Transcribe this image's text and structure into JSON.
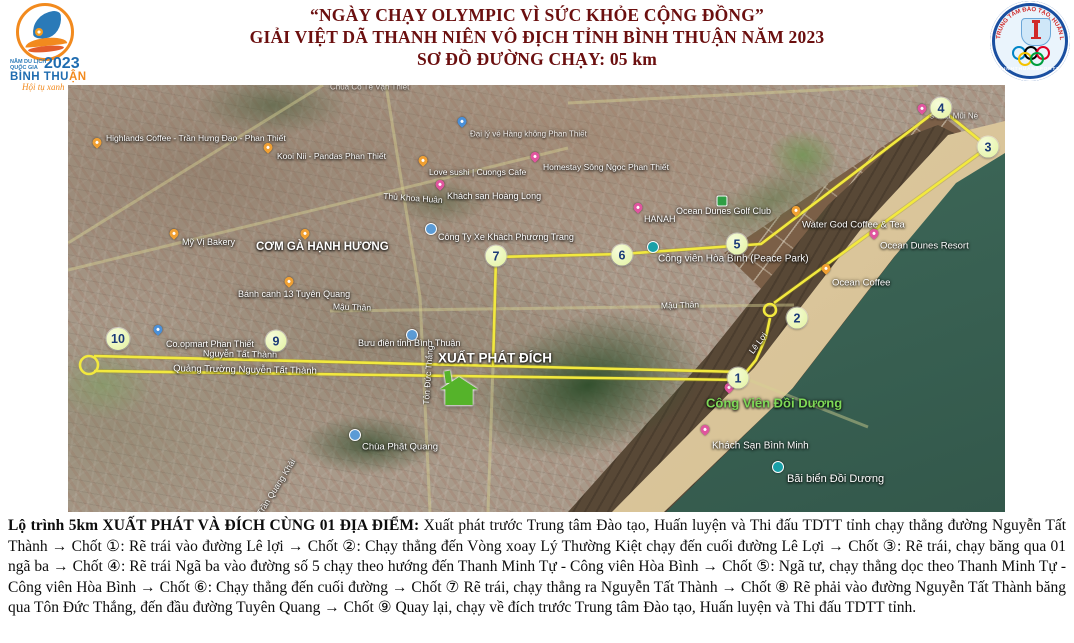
{
  "poster": {
    "title": {
      "line1": "“NGÀY CHẠY OLYMPIC VÌ SỨC KHỎE CỘNG ĐỒNG”",
      "line2": "GIẢI VIỆT DÃ THANH NIÊN VÔ ĐỊCH TỈNH BÌNH THUẬN NĂM 2023",
      "line3": "SƠ ĐỒ ĐƯỜNG CHẠY:  05 km",
      "color": "#6b0f0f"
    },
    "left_logo": {
      "line1": "NĂM DU LỊCH",
      "line2": "QUỐC GIA",
      "year": "2023",
      "name_blue": "BÌNH THU",
      "name_orange": "ẬN",
      "slogan": "Hội tụ xanh"
    },
    "right_logo": {
      "ring_text": "TRUNG TÂM ĐÀO TẠO, HUẤN LUYỆN VÀ THI ĐẤU THỂ DỤC THỂ THAO",
      "bottom_text": "BINHTHUANSPORTS",
      "ring_colors": [
        "#0085C7",
        "#000000",
        "#DF0024",
        "#F4C300",
        "#009F3D"
      ]
    },
    "description": {
      "lead": "Lộ trình 5km XUẤT PHÁT VÀ ĐÍCH CÙNG 01 ĐỊA ĐIỂM:",
      "body": "Xuất phát trước Trung tâm Đào tạo, Huấn luyện và Thi đấu TDTT tỉnh chạy thẳng đường Nguyễn Tất Thành → Chốt ①: Rẽ trái vào đường Lê lợi → Chốt ②: Chạy thẳng đến Vòng xoay Lý Thường Kiệt chạy đến cuối đường Lê Lợi → Chốt ③: Rẽ trái, chạy băng qua 01 ngã ba → Chốt ④: Rẽ trái Ngã ba vào đường số 5 chạy theo hướng đến Thanh Minh Tự - Công viên Hòa Bình → Chốt ⑤: Ngã tư, chạy thẳng dọc theo Thanh Minh Tự - Công viên Hòa Bình → Chốt ⑥: Chạy thẳng đến cuối đường → Chốt ⑦ Rẽ trái, chạy thẳng ra Nguyễn Tất Thành → Chốt ⑧ Rẽ phải vào đường Nguyễn Tất Thành băng qua Tôn Đức Thắng, đến đầu đường Tuyên Quang → Chốt ⑨ Quay lại, chạy về đích trước Trung tâm Đào tạo, Huấn luyện và Thi đấu TDTT tỉnh."
    }
  },
  "map": {
    "route_color": "#f2e93e",
    "checkpoints": [
      {
        "n": "1",
        "x": 670,
        "y": 293
      },
      {
        "n": "2",
        "x": 729,
        "y": 233
      },
      {
        "n": "3",
        "x": 920,
        "y": 62
      },
      {
        "n": "4",
        "x": 873,
        "y": 23
      },
      {
        "n": "5",
        "x": 669,
        "y": 159
      },
      {
        "n": "6",
        "x": 554,
        "y": 170
      },
      {
        "n": "7",
        "x": 428,
        "y": 171
      },
      {
        "n": "9",
        "x": 208,
        "y": 256
      },
      {
        "n": "10",
        "x": 50,
        "y": 254
      }
    ],
    "route": {
      "segments": [
        [
          [
            26,
            271
          ],
          [
            674,
            287
          ]
        ],
        [
          [
            26,
            286
          ],
          [
            676,
            295
          ]
        ],
        [
          [
            675,
            291
          ],
          [
            688,
            275
          ],
          [
            698,
            252
          ],
          [
            702,
            233
          ]
        ],
        [
          [
            706,
            218
          ],
          [
            920,
            62
          ],
          [
            872,
            23
          ],
          [
            693,
            159
          ],
          [
            554,
            169
          ],
          [
            428,
            172
          ],
          [
            425,
            281
          ]
        ]
      ],
      "circles": [
        {
          "x": 702,
          "y": 225,
          "r": 6
        },
        {
          "x": 21,
          "y": 280,
          "r": 9
        }
      ],
      "faint_roads": [
        [
          [
            500,
            18
          ],
          [
            850,
            0
          ]
        ],
        [
          [
            0,
            185
          ],
          [
            500,
            63
          ]
        ],
        [
          [
            0,
            158
          ],
          [
            255,
            0
          ]
        ],
        [
          [
            318,
            0
          ],
          [
            352,
            212
          ]
        ],
        [
          [
            352,
            212
          ],
          [
            362,
            427
          ]
        ],
        [
          [
            262,
            226
          ],
          [
            726,
            220
          ]
        ],
        [
          [
            676,
            293
          ],
          [
            800,
            342
          ]
        ],
        [
          [
            425,
            281
          ],
          [
            420,
            427
          ]
        ]
      ]
    },
    "pois": [
      {
        "label": "Highlands Coffee - Trần Hưng Đạo - Phan Thiết",
        "type": "food",
        "px": 29,
        "py": 61,
        "lx": 38,
        "ly": 53,
        "size": 8.5
      },
      {
        "label": "Kooi Nii - Pandas Phan Thiết",
        "type": "food",
        "px": 200,
        "py": 66,
        "lx": 209,
        "ly": 71,
        "size": 8.5
      },
      {
        "label": "Đại lý vé Hàng không Phan Thiết",
        "type": "place",
        "px": 394,
        "py": 40,
        "lx": 402,
        "ly": 49,
        "size": 8,
        "opacity": 0.85
      },
      {
        "label": "Love sushi | Cuongs Cafe",
        "type": "food",
        "px": 355,
        "py": 79,
        "lx": 361,
        "ly": 87,
        "size": 8.5
      },
      {
        "label": "Khách sạn Hoàng Long",
        "type": "hotel",
        "px": 372,
        "py": 103,
        "lx": 379,
        "ly": 111,
        "size": 9
      },
      {
        "label": "Homestay Sông Ngọc Phan Thiết",
        "type": "hotel",
        "px": 467,
        "py": 75,
        "lx": 475,
        "ly": 82,
        "size": 8.5
      },
      {
        "label": "Mỹ Vị Bakery",
        "type": "food",
        "px": 106,
        "py": 152,
        "lx": 114,
        "ly": 157,
        "size": 9
      },
      {
        "label": "CƠM GÀ HẠNH HƯƠNG",
        "type": "food",
        "px": 237,
        "py": 152,
        "lx": 188,
        "ly": 162,
        "size": 11.5,
        "bold": true
      },
      {
        "label": "Bánh canh 13 Tuyên Quang",
        "type": "food",
        "px": 221,
        "py": 200,
        "lx": 170,
        "ly": 209,
        "size": 9
      },
      {
        "label": "Công Ty Xe Khách Phương Trang",
        "type": "dot-blue",
        "px": 363,
        "py": 144,
        "lx": 370,
        "ly": 152,
        "size": 9
      },
      {
        "label": "HANAH",
        "type": "hotel",
        "px": 570,
        "py": 126,
        "lx": 576,
        "ly": 134,
        "size": 9
      },
      {
        "label": "Ocean Dunes Golf Club",
        "type": "sq-green",
        "px": 654,
        "py": 116,
        "lx": 608,
        "ly": 126,
        "size": 9
      },
      {
        "label": "Công viên Hòa Bình (Peace Park)",
        "type": "dot-teal",
        "px": 585,
        "py": 162,
        "lx": 590,
        "ly": 174,
        "size": 10
      },
      {
        "label": "Water God Coffee & Tea",
        "type": "food",
        "px": 728,
        "py": 129,
        "lx": 734,
        "ly": 140,
        "size": 9.5
      },
      {
        "label": "Ocean Dunes Resort",
        "type": "hotel",
        "px": 806,
        "py": 152,
        "lx": 812,
        "ly": 161,
        "size": 9.5
      },
      {
        "label": "Ocean Coffee",
        "type": "food",
        "px": 758,
        "py": 187,
        "lx": 764,
        "ly": 198,
        "size": 9.5
      },
      {
        "label": "s'Villa Mũi Né",
        "type": "hotel",
        "px": 854,
        "py": 27,
        "lx": 862,
        "ly": 31,
        "size": 8,
        "opacity": 0.8
      },
      {
        "label": "Co.opmart Phan Thiết",
        "type": "place",
        "px": 90,
        "py": 248,
        "lx": 98,
        "ly": 259,
        "size": 9
      },
      {
        "label": "Bưu điện tỉnh Bình Thuận",
        "type": "dot-blue",
        "px": 344,
        "py": 250,
        "lx": 290,
        "ly": 258,
        "size": 9
      },
      {
        "label": "Chùa Phật Quang",
        "type": "dot-blue",
        "px": 287,
        "py": 350,
        "lx": 294,
        "ly": 362,
        "size": 9.5
      },
      {
        "label": "Khách Sạn Bình Minh",
        "type": "hotel",
        "px": 637,
        "py": 348,
        "lx": 644,
        "ly": 361,
        "size": 10
      },
      {
        "label": "Công Viên Đồi Dương",
        "type": "hotel",
        "px": 661,
        "py": 306,
        "lx": 638,
        "ly": 318,
        "size": 13,
        "color": "#7ed957",
        "bold": true
      },
      {
        "label": "Bãi biển Đồi Dương",
        "type": "dot-teal",
        "px": 710,
        "py": 382,
        "lx": 719,
        "ly": 394,
        "size": 11
      },
      {
        "label": "Chùa Cổ Tế Vạn Thiết",
        "type": "none",
        "px": 0,
        "py": 0,
        "lx": 262,
        "ly": 2,
        "size": 8,
        "opacity": 0.7
      }
    ],
    "road_labels": [
      {
        "text": "Thủ Khoa Huân",
        "x": 345,
        "y": 113,
        "rot": 4,
        "size": 8.5
      },
      {
        "text": "Mậu Thân",
        "x": 284,
        "y": 222,
        "rot": 2,
        "size": 8.5
      },
      {
        "text": "Mậu Thân",
        "x": 612,
        "y": 220,
        "rot": -2,
        "size": 8.5
      },
      {
        "text": "Nguyễn Tất Thành",
        "x": 172,
        "y": 269,
        "rot": 1,
        "size": 9
      },
      {
        "text": "Quảng Trường Nguyễn Tất Thành",
        "x": 177,
        "y": 285,
        "rot": 1,
        "size": 9.5
      },
      {
        "text": "Tôn Đức Thắng",
        "x": 360,
        "y": 290,
        "rot": -86,
        "size": 8.5
      },
      {
        "text": "Lê Lợi",
        "x": 690,
        "y": 258,
        "rot": -53,
        "size": 8.5
      },
      {
        "text": "Trần Quang Khải",
        "x": 208,
        "y": 402,
        "rot": -58,
        "size": 8.5,
        "opacity": 0.9
      },
      {
        "text": "XUẤT PHÁT ĐÍCH",
        "x": 427,
        "y": 273,
        "rot": 0,
        "size": 13.5,
        "bold": true
      }
    ],
    "start_house_color": "#55b32a"
  }
}
